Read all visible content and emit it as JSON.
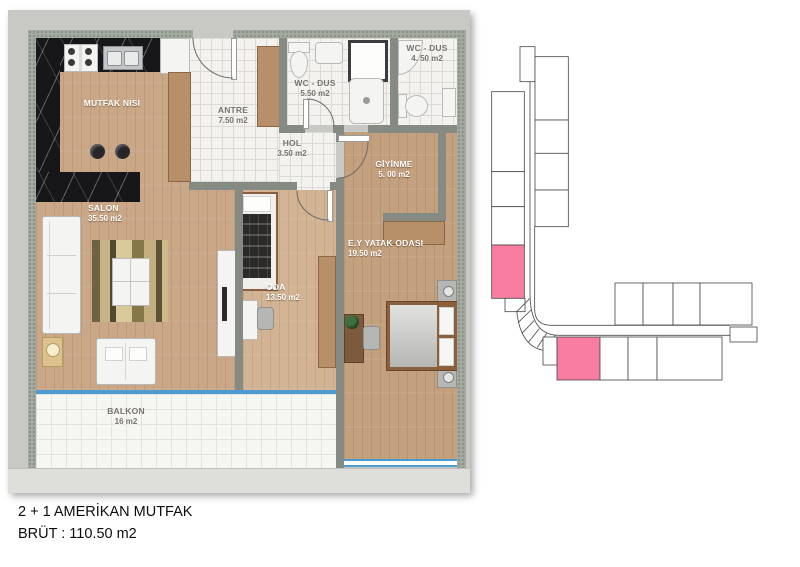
{
  "caption": {
    "line1": "2 + 1 AMERİKAN MUTFAK",
    "line2": "BRÜT : 110.50 m2"
  },
  "rooms": [
    {
      "id": "mutfak",
      "name": "MUTFAK NISI",
      "area": ""
    },
    {
      "id": "antre",
      "name": "ANTRE",
      "area": "7.50 m2"
    },
    {
      "id": "wc1",
      "name": "WC - DUS",
      "area": "5.50 m2"
    },
    {
      "id": "wc2",
      "name": "WC - DUS",
      "area": "4. 50 m2"
    },
    {
      "id": "hol",
      "name": "HOL",
      "area": "3.50 m2"
    },
    {
      "id": "giyinme",
      "name": "GİYİNME",
      "area": "5. 00 m2"
    },
    {
      "id": "salon",
      "name": "SALON",
      "area": "35.50 m2"
    },
    {
      "id": "oda",
      "name": "ODA",
      "area": "13.50 m2"
    },
    {
      "id": "yatak",
      "name": "E.Y YATAK ODASI",
      "area": "19.50 m2"
    },
    {
      "id": "balkon",
      "name": "BALKON",
      "area": "16 m2"
    }
  ],
  "keyplan": {
    "highlighted_units": 2,
    "outline_color": "#4d4d4d",
    "unit_fill": "#ffffff"
  },
  "colors": {
    "highlight": "#f87da1",
    "window": "#4e9bd2",
    "wall": "#a3aaa0",
    "wood": "#c9a787",
    "marble": "#17171a",
    "tile": "#f3f2ef",
    "matte": "#c8c9c5"
  }
}
